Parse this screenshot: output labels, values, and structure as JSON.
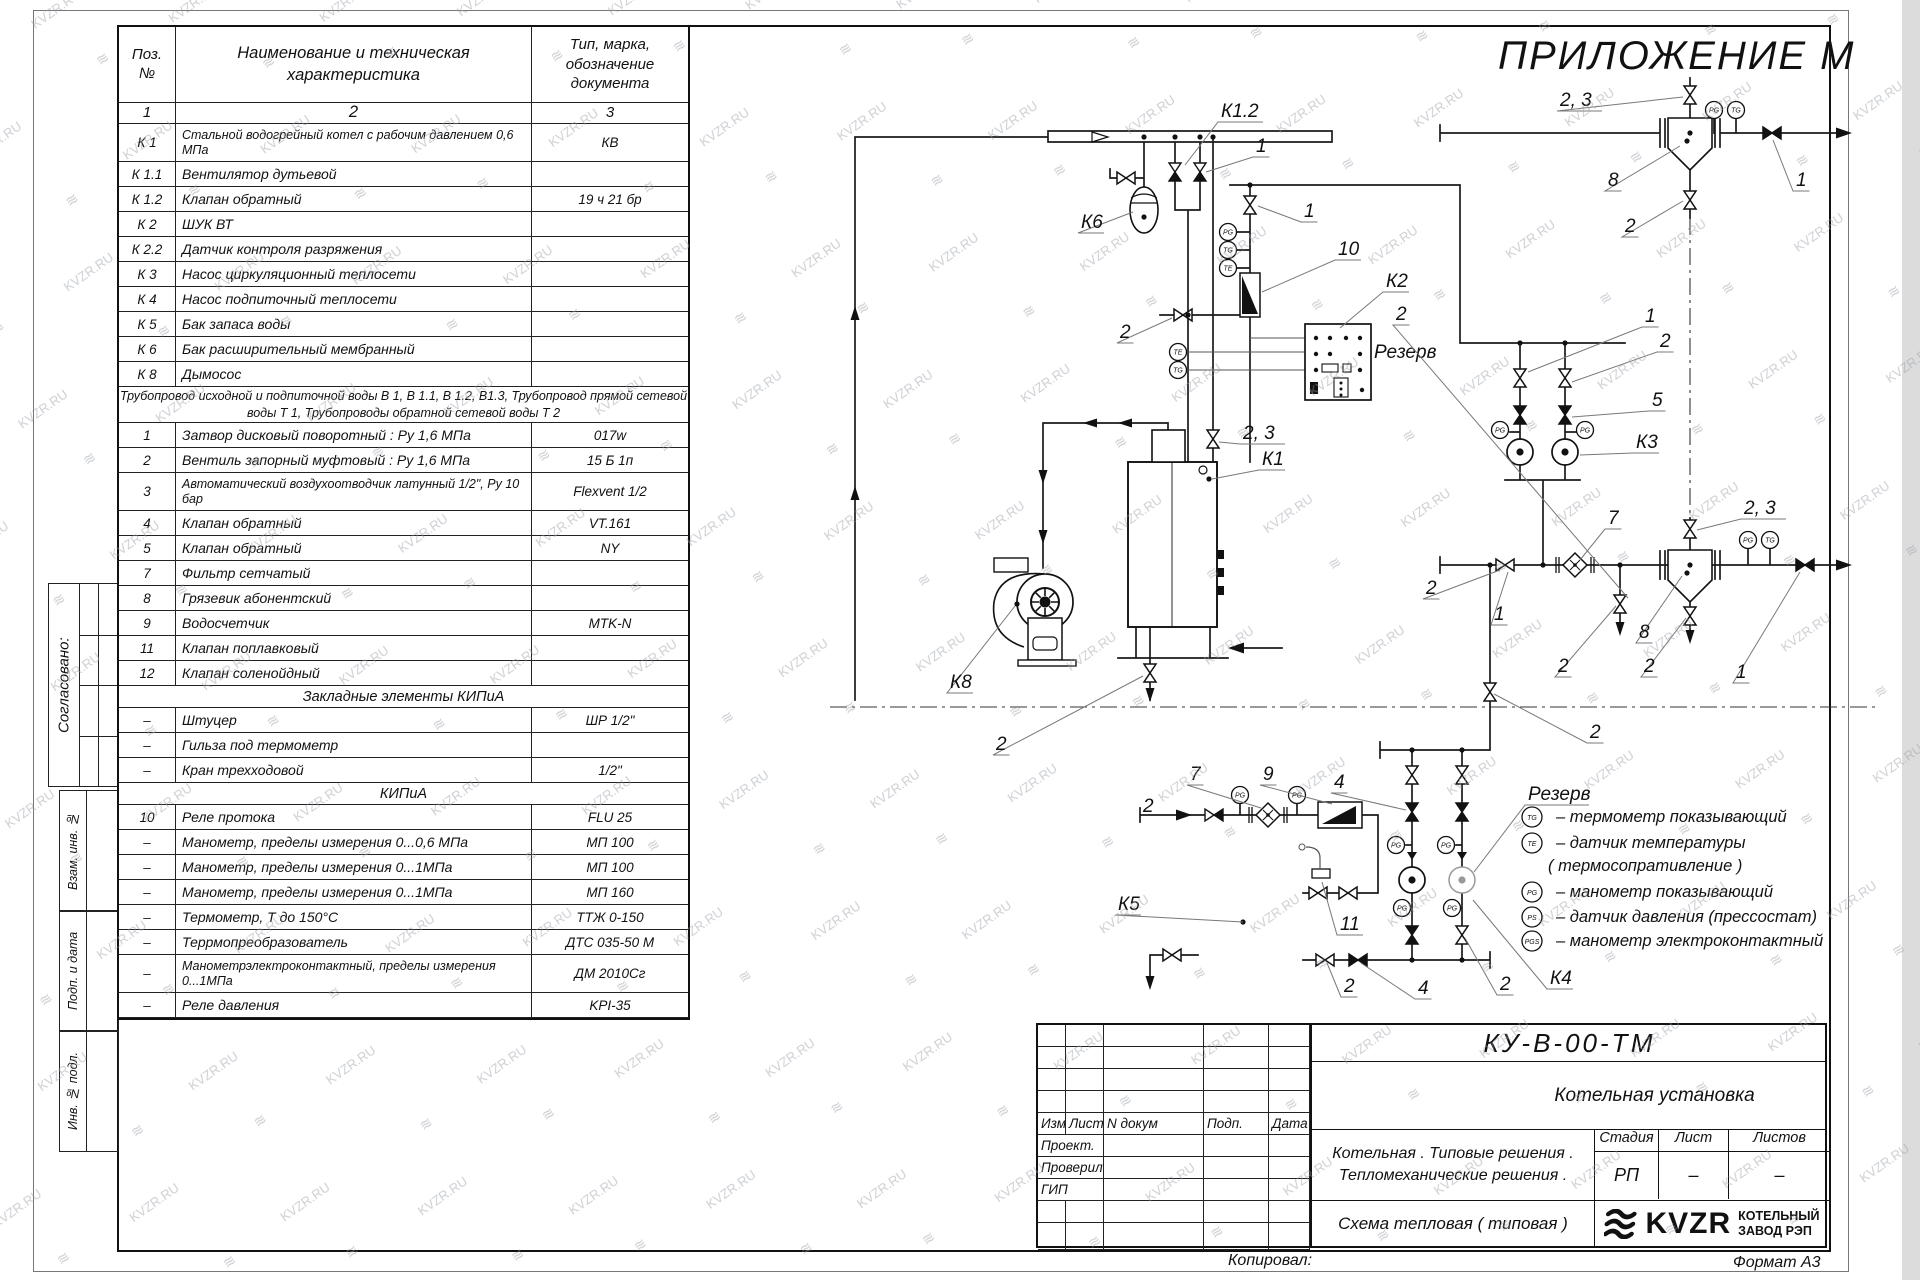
{
  "sheet": {
    "appendix": "ПРИЛОЖЕНИЕ М",
    "copied": "Копировал:",
    "format": "Формат А3"
  },
  "watermark": {
    "text": "KVZR.RU"
  },
  "stamp": {
    "agreed": "Согласовано:",
    "boxes": [
      "Взам. инв. №",
      "Подп. и дата",
      "Инв. № подл."
    ]
  },
  "spec_table": {
    "header": {
      "pos1": "Поз.",
      "pos2": "№",
      "name": "Наименование и техническая характеристика",
      "t1": "Тип, марка,",
      "t2": "обозначение",
      "t3": "документа"
    },
    "index": [
      "1",
      "2",
      "3"
    ],
    "rows": [
      {
        "p": "К 1",
        "n": "Стальной водогрейный котел с рабочим давлением 0,6  МПа",
        "t": "КВ",
        "k": "i2"
      },
      {
        "p": "К 1.1",
        "n": "Вентилятор дутьевой",
        "t": "",
        "k": "i"
      },
      {
        "p": "К 1.2",
        "n": "Клапан обратный",
        "t": "19 ч 21 бр",
        "k": "i"
      },
      {
        "p": "К 2",
        "n": "ШУК ВТ",
        "t": "",
        "k": "i"
      },
      {
        "p": "К 2.2",
        "n": "Датчик контроля разряжения",
        "t": "",
        "k": "i"
      },
      {
        "p": "К 3",
        "n": "Насос циркуляционный теплосети",
        "t": "",
        "k": "i"
      },
      {
        "p": "К 4",
        "n": "Насос подпиточный теплосети",
        "t": "",
        "k": "i"
      },
      {
        "p": "К 5",
        "n": "Бак запаса воды",
        "t": "",
        "k": "i"
      },
      {
        "p": "К 6",
        "n": "Бак расширительный мембранный",
        "t": "",
        "k": "i"
      },
      {
        "p": "К 8",
        "n": "Дымосос",
        "t": "",
        "k": "i"
      },
      {
        "n": "Трубопровод исходной и подпиточной воды В 1,   В 1.1,   В 1.2, В1.3,  Трубопровод прямой сетевой воды Т 1,  Трубопроводы обратной сетевой воды Т 2",
        "k": "n"
      },
      {
        "p": "1",
        "n": "Затвор дисковый поворотный :  Ру 1,6  МПа",
        "t": "017w",
        "k": "i"
      },
      {
        "p": "2",
        "n": "Вентиль запорный муфтовый :  Ру 1,6  МПа",
        "t": "15 Б 1п",
        "k": "i"
      },
      {
        "p": "3",
        "n": "Автоматический воздухоотводчик   латунный 1/2\",  Ру  10  бар",
        "t": "Flexvent 1/2",
        "k": "i2"
      },
      {
        "p": "4",
        "n": "Клапан обратный",
        "t": "VT.161",
        "k": "i"
      },
      {
        "p": "5",
        "n": "Клапан обратный",
        "t": "NY",
        "k": "i"
      },
      {
        "p": "7",
        "n": "Фильтр сетчатый",
        "t": "",
        "k": "i"
      },
      {
        "p": "8",
        "n": "Грязевик абонентский",
        "t": "",
        "k": "i"
      },
      {
        "p": "9",
        "n": "Водосчетчик",
        "t": "MTK-N",
        "k": "i"
      },
      {
        "p": "11",
        "n": "Клапан поплавковый",
        "t": "",
        "k": "i"
      },
      {
        "p": "12",
        "n": "Клапан соленойдный",
        "t": "",
        "k": "i"
      },
      {
        "n": "Закладные элементы КИПиА",
        "k": "s"
      },
      {
        "p": "–",
        "n": "Штуцер",
        "t": "ШР  1/2\"",
        "k": "i"
      },
      {
        "p": "–",
        "n": "Гильза под термометр",
        "t": "",
        "k": "i"
      },
      {
        "p": "–",
        "n": "Кран трехходовой",
        "t": "1/2\"",
        "k": "i"
      },
      {
        "n": "КИПиА",
        "k": "s"
      },
      {
        "p": "10",
        "n": "Реле протока",
        "t": "FLU 25",
        "k": "i"
      },
      {
        "p": "–",
        "n": "Манометр, пределы измерения  0...0,6 МПа",
        "t": "МП 100",
        "k": "i"
      },
      {
        "p": "–",
        "n": "Манометр, пределы измерения  0...1МПа",
        "t": "МП 100",
        "k": "i"
      },
      {
        "p": "–",
        "n": "Манометр, пределы измерения  0...1МПа",
        "t": "МП 160",
        "k": "i"
      },
      {
        "p": "–",
        "n": "Термометр, Т  до  150°С",
        "t": "ТТЖ  0-150",
        "k": "i"
      },
      {
        "p": "–",
        "n": "Террмопреобразователь",
        "t": "ДТС 035-50 М",
        "k": "i"
      },
      {
        "p": "–",
        "n": "Манометрэлектроконтактный, пределы измерения 0...1МПа",
        "t": "ДМ 2010Сг",
        "k": "i2"
      },
      {
        "p": "–",
        "n": "Реле давления",
        "t": "KPI-35",
        "k": "i"
      }
    ]
  },
  "diagram": {
    "callouts": [
      {
        "t": "К1.2",
        "x": 1221,
        "y": 117,
        "lx": 1185,
        "ly": 165
      },
      {
        "t": "1",
        "x": 1256,
        "y": 152,
        "lx": 1206,
        "ly": 172
      },
      {
        "t": "К6",
        "x": 1081,
        "y": 228,
        "lx": 1133,
        "ly": 212
      },
      {
        "t": "2",
        "x": 1120,
        "y": 338,
        "lx": 1172,
        "ly": 318
      },
      {
        "t": "10",
        "x": 1338,
        "y": 255,
        "lx": 1262,
        "ly": 292
      },
      {
        "t": "1",
        "x": 1304,
        "y": 217,
        "lx": 1258,
        "ly": 206
      },
      {
        "t": "К2",
        "x": 1386,
        "y": 287,
        "lx": 1340,
        "ly": 328
      },
      {
        "t": "Резерв",
        "x": 1374,
        "y": 358
      },
      {
        "t": "2",
        "x": 1396,
        "y": 320,
        "lx": 1628,
        "ly": 598
      },
      {
        "t": "2, 3",
        "x": 1243,
        "y": 439,
        "lx": 1219,
        "ly": 442
      },
      {
        "t": "К1",
        "x": 1262,
        "y": 465,
        "lx": 1212,
        "ly": 479
      },
      {
        "t": "К8",
        "x": 950,
        "y": 688,
        "lx": 1015,
        "ly": 606
      },
      {
        "t": "2",
        "x": 996,
        "y": 750,
        "lx": 1143,
        "ly": 676
      },
      {
        "t": "1",
        "x": 1645,
        "y": 322,
        "lx": 1528,
        "ly": 372
      },
      {
        "t": "2",
        "x": 1660,
        "y": 347,
        "lx": 1572,
        "ly": 382
      },
      {
        "t": "5",
        "x": 1652,
        "y": 406,
        "lx": 1572,
        "ly": 417
      },
      {
        "t": "К3",
        "x": 1636,
        "y": 448,
        "lx": 1580,
        "ly": 455
      },
      {
        "t": "7",
        "x": 1608,
        "y": 524,
        "lx": 1580,
        "ly": 560
      },
      {
        "t": "2, 3",
        "x": 1744,
        "y": 514,
        "lx": 1697,
        "ly": 530
      },
      {
        "t": "1",
        "x": 1494,
        "y": 620,
        "lx": 1508,
        "ly": 572
      },
      {
        "t": "2",
        "x": 1426,
        "y": 594,
        "lx": 1500,
        "ly": 570
      },
      {
        "t": "8",
        "x": 1639,
        "y": 638,
        "lx": 1682,
        "ly": 576
      },
      {
        "t": "2",
        "x": 1558,
        "y": 672,
        "lx": 1616,
        "ly": 606
      },
      {
        "t": "2",
        "x": 1644,
        "y": 672,
        "lx": 1686,
        "ly": 618
      },
      {
        "t": "1",
        "x": 1736,
        "y": 678,
        "lx": 1800,
        "ly": 572
      },
      {
        "t": "2",
        "x": 1590,
        "y": 738,
        "lx": 1494,
        "ly": 694
      },
      {
        "t": "2, 3",
        "x": 1560,
        "y": 106,
        "lx": 1683,
        "ly": 97
      },
      {
        "t": "8",
        "x": 1608,
        "y": 186,
        "lx": 1680,
        "ly": 146
      },
      {
        "t": "2",
        "x": 1625,
        "y": 232,
        "lx": 1683,
        "ly": 201
      },
      {
        "t": "1",
        "x": 1796,
        "y": 186,
        "lx": 1773,
        "ly": 140
      },
      {
        "t": "7",
        "x": 1190,
        "y": 780,
        "lx": 1261,
        "ly": 808
      },
      {
        "t": "9",
        "x": 1263,
        "y": 780,
        "lx": 1332,
        "ly": 804
      },
      {
        "t": "4",
        "x": 1334,
        "y": 788,
        "lx": 1406,
        "ly": 810
      },
      {
        "t": "2",
        "x": 1143,
        "y": 812
      },
      {
        "t": "К5",
        "x": 1118,
        "y": 910,
        "lx": 1243,
        "ly": 922
      },
      {
        "t": "11",
        "x": 1340,
        "y": 930,
        "lx": 1322,
        "ly": 882
      },
      {
        "t": "2",
        "x": 1344,
        "y": 992,
        "lx": 1327,
        "ly": 963
      },
      {
        "t": "4",
        "x": 1418,
        "y": 994,
        "lx": 1361,
        "ly": 963
      },
      {
        "t": "2",
        "x": 1500,
        "y": 990,
        "lx": 1465,
        "ly": 938
      },
      {
        "t": "Резерв",
        "x": 1528,
        "y": 800,
        "u": true,
        "lx": 1474,
        "ly": 872
      },
      {
        "t": "К4",
        "x": 1550,
        "y": 984,
        "lx": 1473,
        "ly": 900
      }
    ],
    "gauges": [
      {
        "t": "PG",
        "x": 1228,
        "y": 232
      },
      {
        "t": "TG",
        "x": 1228,
        "y": 250
      },
      {
        "t": "TE",
        "x": 1228,
        "y": 268
      },
      {
        "t": "TE",
        "x": 1178,
        "y": 352
      },
      {
        "t": "TG",
        "x": 1178,
        "y": 370
      },
      {
        "t": "PG",
        "x": 1714,
        "y": 110
      },
      {
        "t": "TG",
        "x": 1736,
        "y": 110
      },
      {
        "t": "PG",
        "x": 1748,
        "y": 540
      },
      {
        "t": "TG",
        "x": 1770,
        "y": 540
      },
      {
        "t": "PG",
        "x": 1500,
        "y": 430
      },
      {
        "t": "PG",
        "x": 1585,
        "y": 430
      },
      {
        "t": "PG",
        "x": 1240,
        "y": 795
      },
      {
        "t": "PG",
        "x": 1297,
        "y": 795
      },
      {
        "t": "PG",
        "x": 1396,
        "y": 845
      },
      {
        "t": "PG",
        "x": 1446,
        "y": 845
      },
      {
        "t": "PG",
        "x": 1402,
        "y": 908
      },
      {
        "t": "PG",
        "x": 1452,
        "y": 908
      }
    ],
    "legend": {
      "items": [
        {
          "tag": "TG",
          "text": "–  термометр показывающий",
          "y": 822
        },
        {
          "tag": "TE",
          "text": "–  датчик температуры",
          "y": 848
        },
        {
          "tag": "",
          "text": "( термосопративление )",
          "y": 871
        },
        {
          "tag": "PG",
          "text": "–  манометр показывающий",
          "y": 897
        },
        {
          "tag": "PS",
          "text": "–  датчик давления  (прессостат)",
          "y": 922
        },
        {
          "tag": "PGS",
          "text": "–  манометр электроконтактный",
          "y": 946
        }
      ]
    }
  },
  "title_block": {
    "doc_number": "КУ-В-00-ТМ",
    "object": "Котельная установка",
    "desc1": "Котельная . Типовые решения .",
    "desc2": "Тепломеханические решения .",
    "stage_label": "Стадия",
    "sheet_label": "Лист",
    "sheets_label": "Листов",
    "stage": "РП",
    "sheet": "–",
    "sheets": "–",
    "sheet_name": "Схема тепловая  ( типовая )",
    "rev_cols": [
      "Изм",
      "Лист",
      "N докум",
      "Подп.",
      "Дата"
    ],
    "roles": [
      "Проект.",
      "Проверил",
      "ГИП"
    ],
    "logo": {
      "brand": "KVZR",
      "caption1": "КОТЕЛЬНЫЙ",
      "caption2": "ЗАВОД РЭП"
    }
  }
}
